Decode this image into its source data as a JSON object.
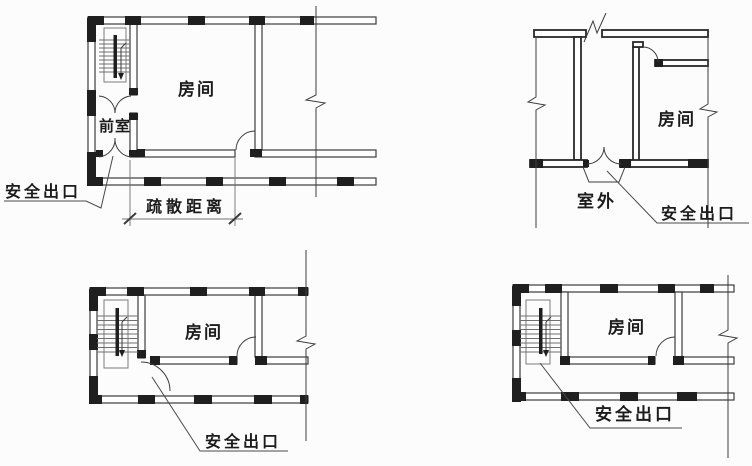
{
  "colors": {
    "line": "#3c3c3c",
    "pier": "#1f1f1f",
    "thin": "#6f6f6f",
    "text": "#1c1c1c",
    "bg": "#fcfcfc"
  },
  "diagrams": {
    "top_left": {
      "room_label": "房间",
      "vestibule_label": "前室",
      "exit_label": "安全出口",
      "distance_label": "疏散距离"
    },
    "top_right": {
      "room_label": "房间",
      "outside_label": "室外",
      "exit_label": "安全出口"
    },
    "bottom_left": {
      "room_label": "房间",
      "exit_label": "安全出口"
    },
    "bottom_right": {
      "room_label": "房间",
      "exit_label": "安全出口"
    }
  }
}
